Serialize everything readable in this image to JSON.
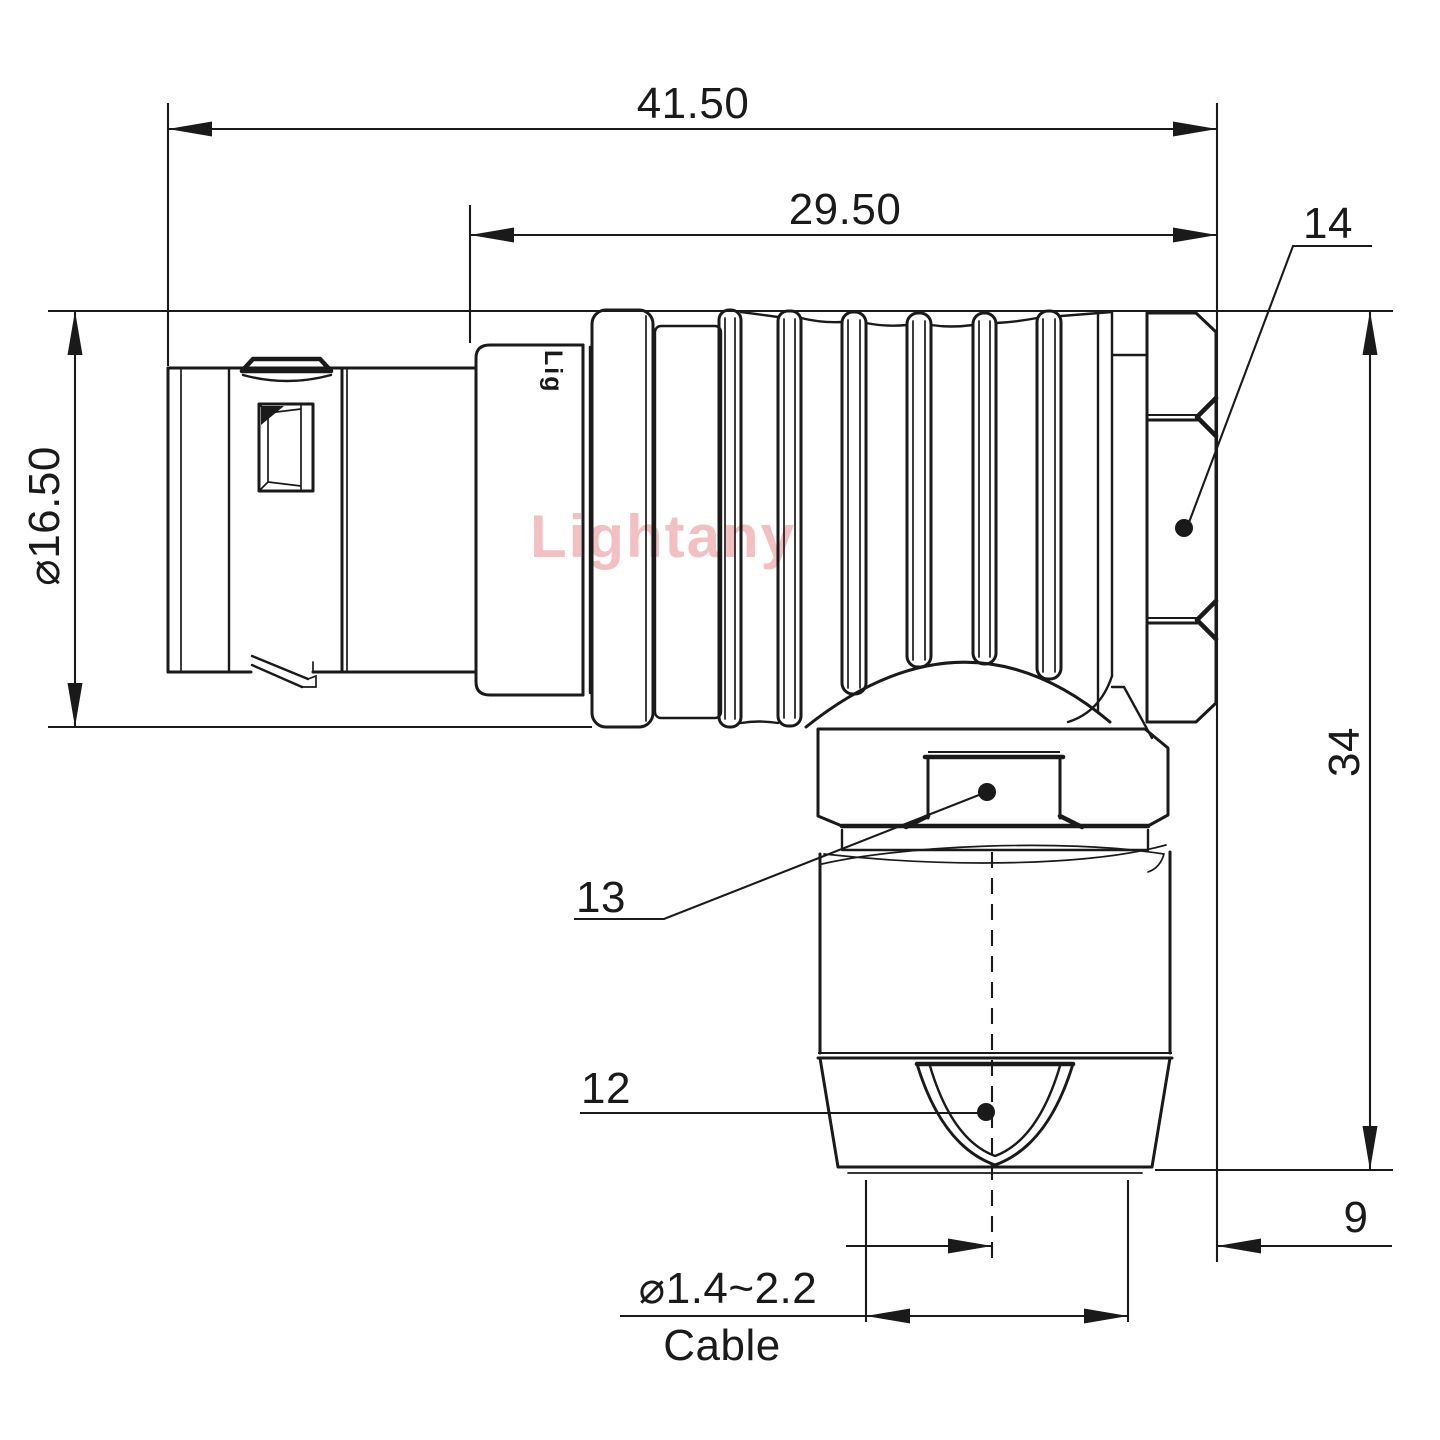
{
  "drawing": {
    "colors": {
      "line": "#1a1a1a",
      "background": "#ffffff",
      "watermark": "#f0b6b6"
    },
    "watermark": {
      "text": "Lightany"
    },
    "engraving": {
      "text": "Lig"
    },
    "dimensions": {
      "overall_length": "41.50",
      "rear_section_length": "29.50",
      "front_diameter": "⌀16.50",
      "elbow_height": "34",
      "axis_offset": "9",
      "cable_diameter_range": "⌀1.4~2.2",
      "cable_label": "Cable"
    },
    "callouts": {
      "coupling_nut": "14",
      "elbow_hex_nut": "13",
      "cable_clamp": "12"
    }
  }
}
